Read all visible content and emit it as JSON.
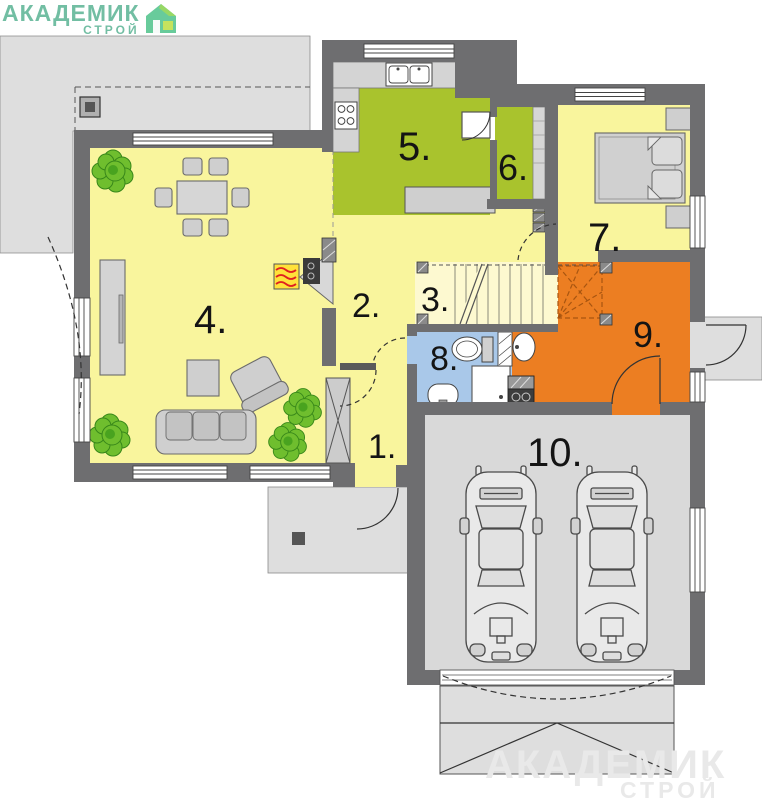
{
  "brand": {
    "name": "АКАДЕМИК",
    "sub": "СТРОЙ"
  },
  "watermark": {
    "name": "АКАДЕМИК",
    "sub": "СТРОЙ"
  },
  "rooms": [
    {
      "label": "1."
    },
    {
      "label": "2."
    },
    {
      "label": "3."
    },
    {
      "label": "4."
    },
    {
      "label": "5."
    },
    {
      "label": "6."
    },
    {
      "label": "7."
    },
    {
      "label": "8."
    },
    {
      "label": "9."
    },
    {
      "label": "10."
    }
  ],
  "colors": {
    "wall": "#6e6e70",
    "floor_yellow": "#f9f59d",
    "floor_stairs": "#fdf9d0",
    "floor_green": "#a9c32d",
    "floor_blue": "#a9c8e9",
    "floor_orange": "#ec7e22",
    "exterior_gray": "#dedede",
    "garage_gray": "#d9d9d9",
    "furniture_gray": "#cfcfcf",
    "plant_green": "#6fbe2e",
    "brand_green": "#4fae8d",
    "fire_yellow": "#ffe23a",
    "fire_red": "#e02020"
  }
}
